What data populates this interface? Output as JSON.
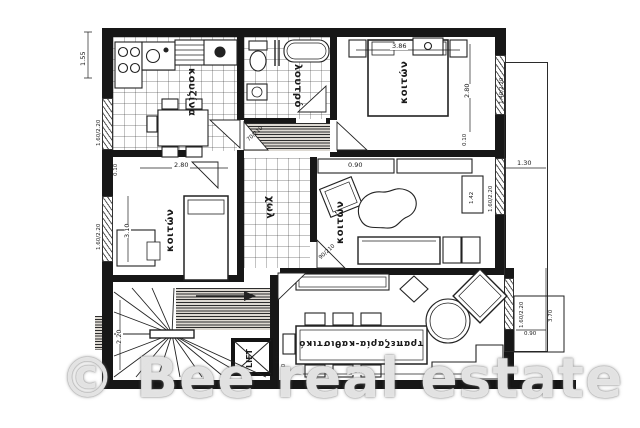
{
  "watermark": "© Bee real estate",
  "colors": {
    "ink": "#171717",
    "paper": "#ffffff",
    "watermark": "#eeeeee"
  },
  "rooms": {
    "kitchen": "κουζίνα",
    "bathroom": "λουτρό",
    "bedroom_top": "κοιτών",
    "bedroom_left": "κοιτών",
    "bedroom_right": "κοιτών",
    "hall": "χωλ",
    "lift": "LIFT",
    "living_dining": "τραπεζαρία-καθιστικό"
  },
  "dimensions": {
    "left_height": "1.55",
    "window_kitchen": "1.60/2.20",
    "window_bedroom_left": "1.60/2.20",
    "window_bedroom_top": "1.40/2.20",
    "window_bedroom_right": "1.60/2.20",
    "window_dining": "1.60/2.20",
    "bedroom_top_width": "3.86",
    "bedroom_top_depth": "2.80",
    "bedroom_top_offset": "0.10",
    "bedroom_left_depth": "3.10",
    "bedroom_left_width": "2.80",
    "bedroom_left_offset": "0.10",
    "bedroom_right_shelf": "0.90",
    "bedroom_right_wardrobe": "1.42",
    "door_bedroom_right": "90/210",
    "door_hall": "70/210",
    "dining_width": "3.95",
    "dining_left": "0.80",
    "stairs_width": "2.20",
    "lift_width": "1.30",
    "balcony_width": "1.30",
    "terrace_depth": "3.70",
    "terrace_width": "0.90"
  }
}
